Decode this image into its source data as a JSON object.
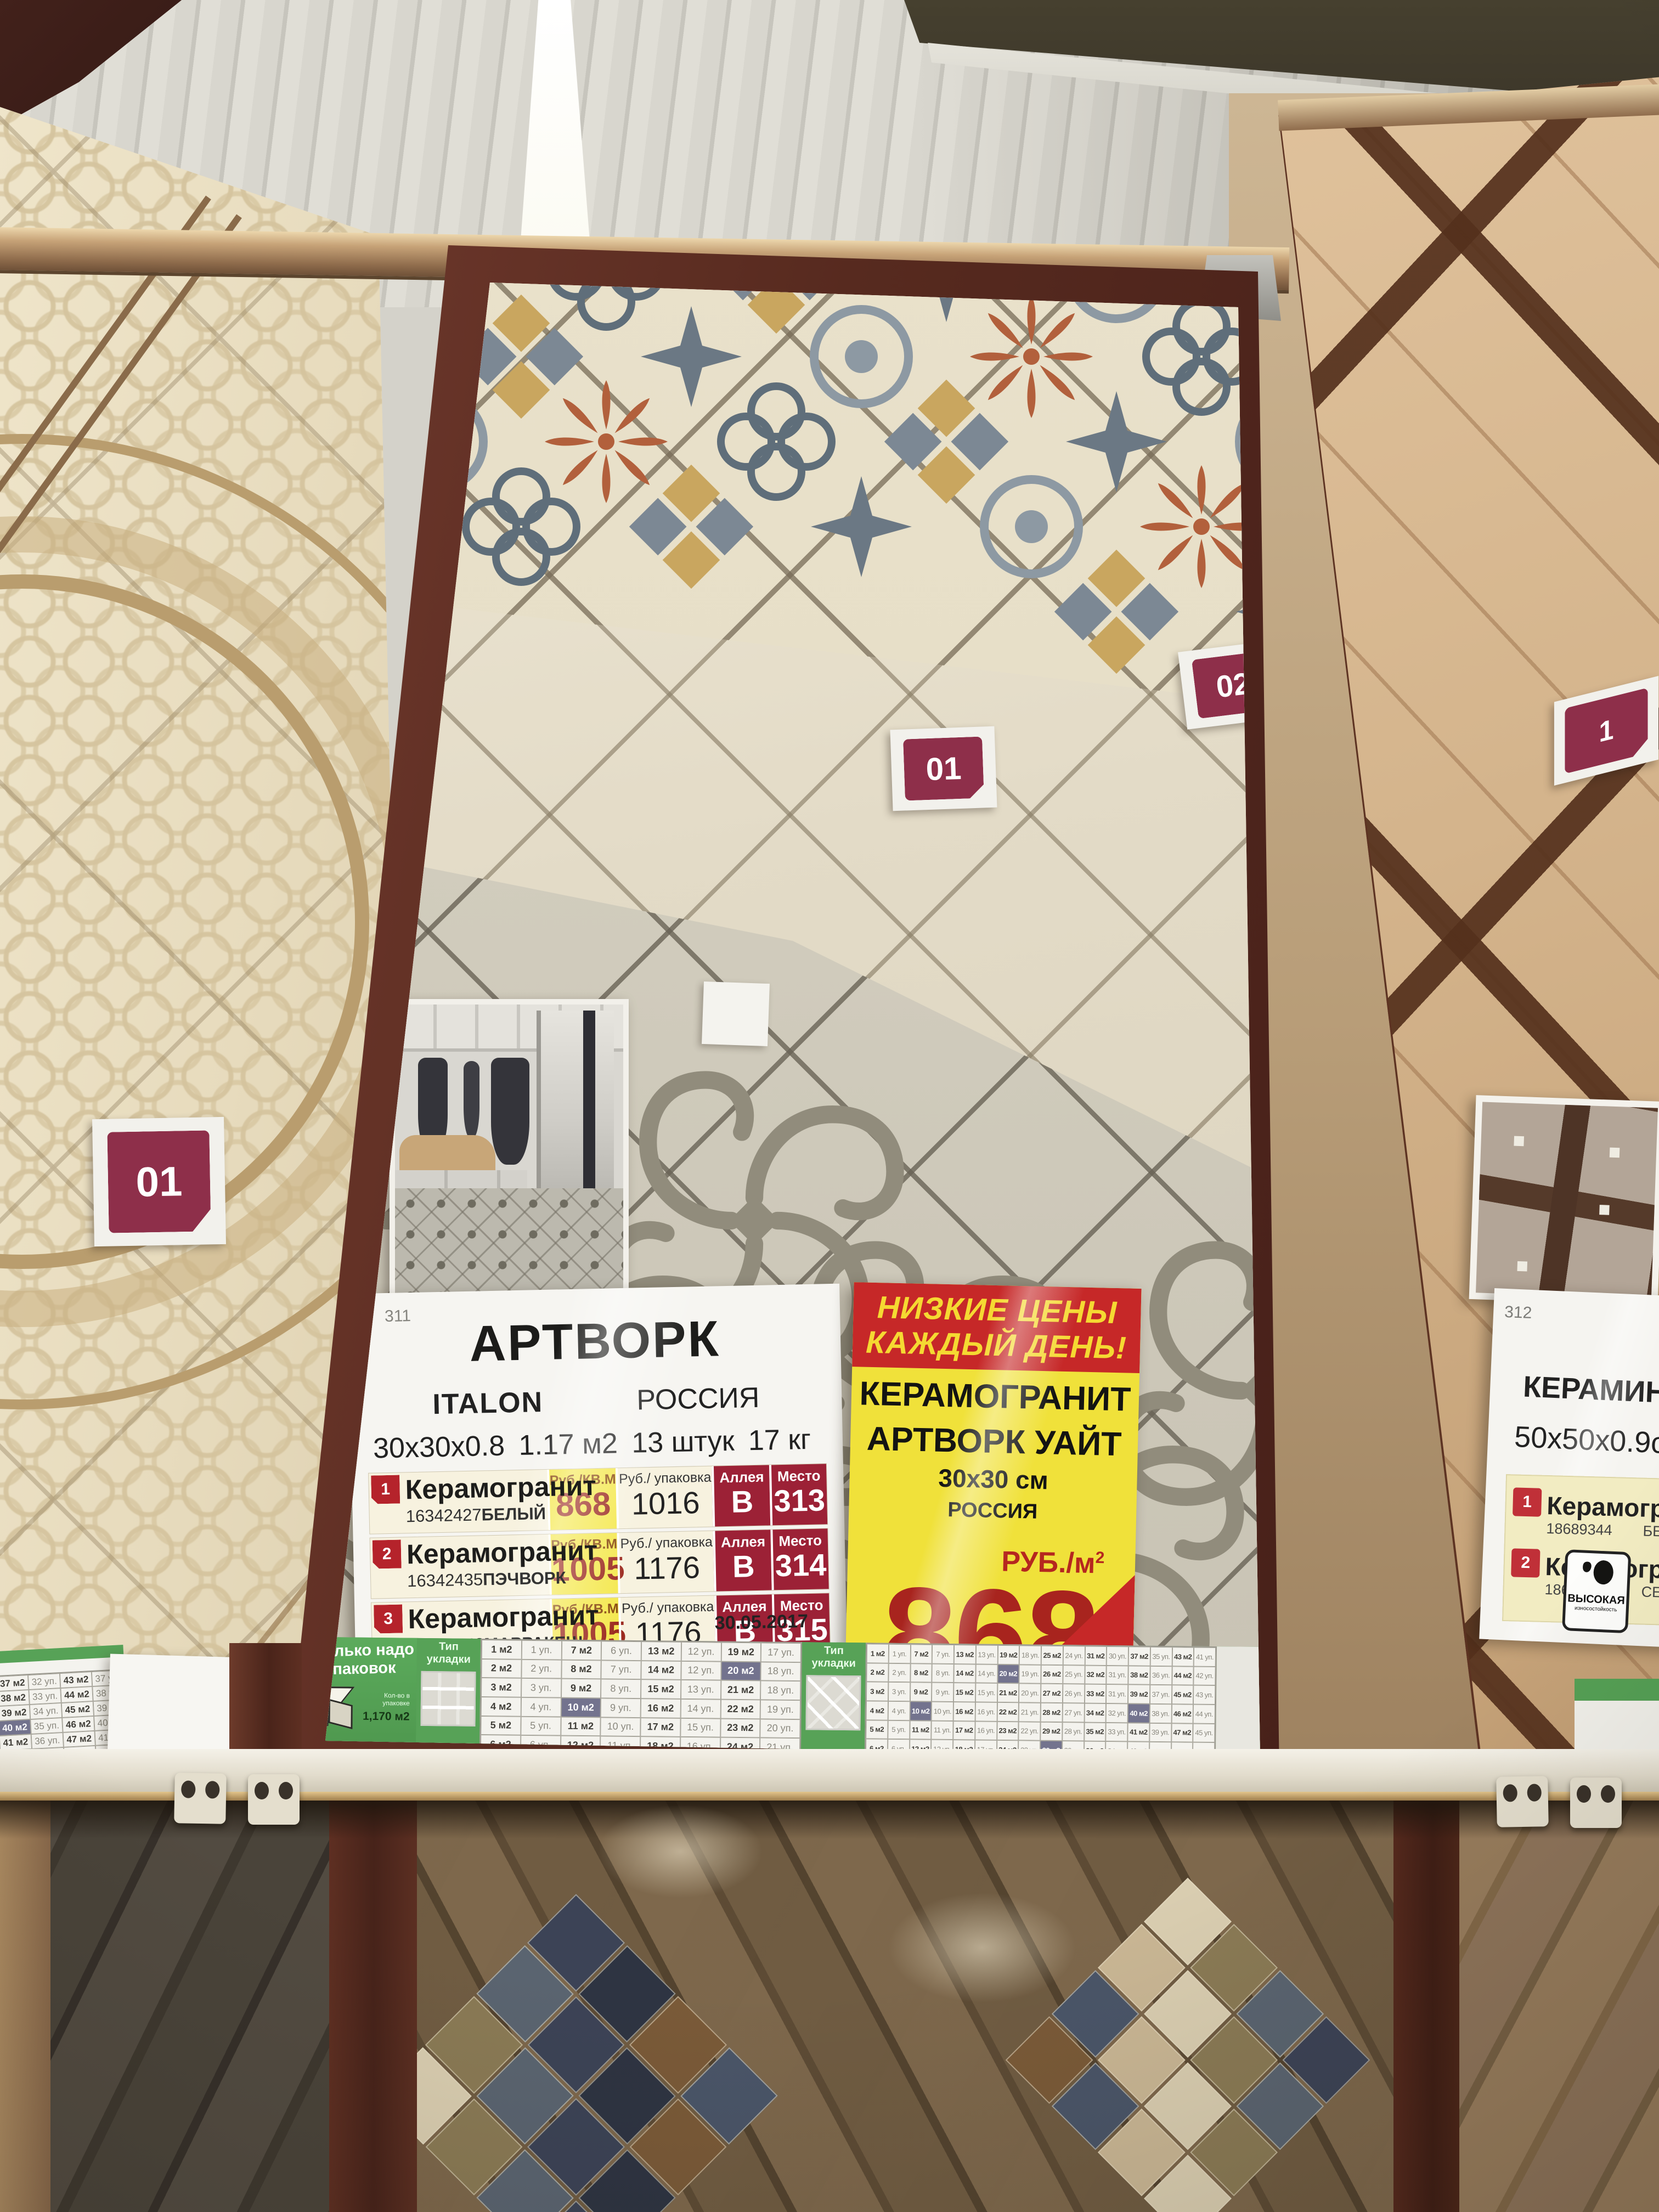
{
  "badges": {
    "left_panel": "01",
    "main_near": "01",
    "main_far": "02",
    "right_panel": "1"
  },
  "info_sheet": {
    "sheet_number": "311",
    "title": "АРТВОРК",
    "brand": "ITALON",
    "country": "РОССИЯ",
    "size": "30х30х0.8",
    "area_per_pack": "1.17 м2",
    "pieces": "13 штук",
    "weight": "17 кг",
    "col_headers": {
      "price_sqm": "Руб./КВ.М",
      "price_pack": "Руб./ упаковка",
      "aisle": "Аллея",
      "place": "Место"
    },
    "rows": [
      {
        "num": "1",
        "name": "Керамогранит",
        "code": "16342427",
        "color": "БЕЛЫЙ",
        "price_sqm": "868",
        "price_pack": "1016",
        "aisle": "В",
        "place": "313"
      },
      {
        "num": "2",
        "name": "Керамогранит",
        "code": "16342435",
        "color": "ПЭЧВОРК",
        "price_sqm": "1005",
        "price_pack": "1176",
        "aisle": "В",
        "place": "314"
      },
      {
        "num": "3",
        "name": "Керамогранит",
        "code": "16342443",
        "color": "МАРРАКЕШ",
        "price_sqm": "1005",
        "price_pack": "1176",
        "aisle": "В",
        "place": "315"
      }
    ],
    "icons": [
      {
        "name": "snowflake-icon",
        "label": "морозостойкая"
      },
      {
        "name": "wear-resistance-icon",
        "label_top": "ВЫСОКАЯ",
        "label_bottom": "износостойкость"
      }
    ],
    "date": "30.05.2017"
  },
  "price_tag": {
    "banner_line1": "НИЗКИЕ ЦЕНЫ",
    "banner_line2": "КАЖДЫЙ ДЕНЬ!",
    "product_line1": "КЕРАМОГРАНИТ",
    "product_line2": "АРТВОРК УАЙТ",
    "size": "30х30 см",
    "country": "РОССИЯ",
    "unit": "РУБ./м",
    "unit_sup": "2",
    "price": "868",
    "pack_info": "1 уп.=1,17кв.м",
    "sku": "ЛМ 16342427",
    "pack_price": "1015,56РУБ./у",
    "date": "24.01.2018"
  },
  "right_sheet": {
    "sheet_number": "312",
    "title_partial": "ВУ",
    "brand": "КЕРАМИН",
    "size": "50х50х0.9см",
    "rows": [
      {
        "num": "1",
        "name": "Керамогранит",
        "code": "18689344",
        "color": "БЕЖЕВЫЙ"
      },
      {
        "num": "2",
        "name": "Керамогранит",
        "code": "18689336",
        "color": "СЕ"
      }
    ],
    "icon_label_top": "ВЫСОКАЯ",
    "icon_label_bottom": "износостойкость"
  },
  "calc_strip": {
    "label_line1": "Сколько надо",
    "label_line2": "Упаковок",
    "pack_note": "Кол-во в упаковке",
    "pack_area": "1,170 м2",
    "layout_header": "Тип укладки",
    "unit_area": "м2",
    "unit_pack": "уп.",
    "straight_pairs": [
      [
        1,
        1
      ],
      [
        2,
        2
      ],
      [
        3,
        3
      ],
      [
        4,
        4
      ],
      [
        5,
        5
      ],
      [
        6,
        6
      ],
      [
        7,
        6
      ],
      [
        8,
        7
      ],
      [
        9,
        8
      ],
      [
        10,
        9
      ],
      [
        11,
        10
      ],
      [
        12,
        11
      ],
      [
        13,
        12
      ],
      [
        14,
        12
      ],
      [
        15,
        13
      ],
      [
        16,
        14
      ],
      [
        17,
        15
      ],
      [
        18,
        16
      ],
      [
        19,
        17
      ],
      [
        20,
        18
      ],
      [
        21,
        18
      ],
      [
        22,
        19
      ],
      [
        23,
        20
      ],
      [
        24,
        21
      ]
    ],
    "diagonal_pairs": [
      [
        1,
        1
      ],
      [
        2,
        2
      ],
      [
        3,
        3
      ],
      [
        4,
        4
      ],
      [
        5,
        5
      ],
      [
        6,
        6
      ],
      [
        7,
        7
      ],
      [
        8,
        8
      ],
      [
        9,
        9
      ],
      [
        10,
        10
      ],
      [
        11,
        11
      ],
      [
        12,
        12
      ],
      [
        13,
        13
      ],
      [
        14,
        14
      ],
      [
        15,
        15
      ],
      [
        16,
        16
      ],
      [
        17,
        16
      ],
      [
        18,
        17
      ],
      [
        19,
        18
      ],
      [
        20,
        19
      ],
      [
        21,
        20
      ],
      [
        22,
        21
      ],
      [
        23,
        22
      ],
      [
        24,
        23
      ],
      [
        25,
        24
      ],
      [
        26,
        25
      ],
      [
        27,
        26
      ],
      [
        28,
        27
      ],
      [
        29,
        28
      ],
      [
        30,
        29
      ],
      [
        31,
        30
      ],
      [
        32,
        31
      ],
      [
        33,
        31
      ],
      [
        34,
        32
      ],
      [
        35,
        33
      ],
      [
        36,
        34
      ],
      [
        37,
        35
      ],
      [
        38,
        36
      ],
      [
        39,
        37
      ],
      [
        40,
        38
      ],
      [
        41,
        39
      ],
      [
        42,
        40
      ],
      [
        43,
        41
      ],
      [
        44,
        42
      ],
      [
        45,
        43
      ],
      [
        46,
        44
      ],
      [
        47,
        45
      ],
      [
        48,
        46
      ]
    ],
    "left_fragment_pairs": [
      [
        37,
        32
      ],
      [
        38,
        33
      ],
      [
        39,
        34
      ],
      [
        40,
        35
      ],
      [
        41,
        36
      ],
      [
        42,
        36
      ],
      [
        43,
        37
      ],
      [
        44,
        38
      ],
      [
        45,
        39
      ],
      [
        46,
        40
      ],
      [
        47,
        41
      ],
      [
        48,
        42
      ]
    ]
  },
  "colors": {
    "badge_maroon": "#8e2f4a",
    "banner_red": "#c62828",
    "tag_yellow": "#f0e13a",
    "price_red": "#a8241e",
    "table_dark_red": "#9c2136",
    "row_badge_red": "#b5232b",
    "strip_green": "#57a257",
    "highlight_cell": "#73738e",
    "frame_brown": "#572a1f"
  }
}
